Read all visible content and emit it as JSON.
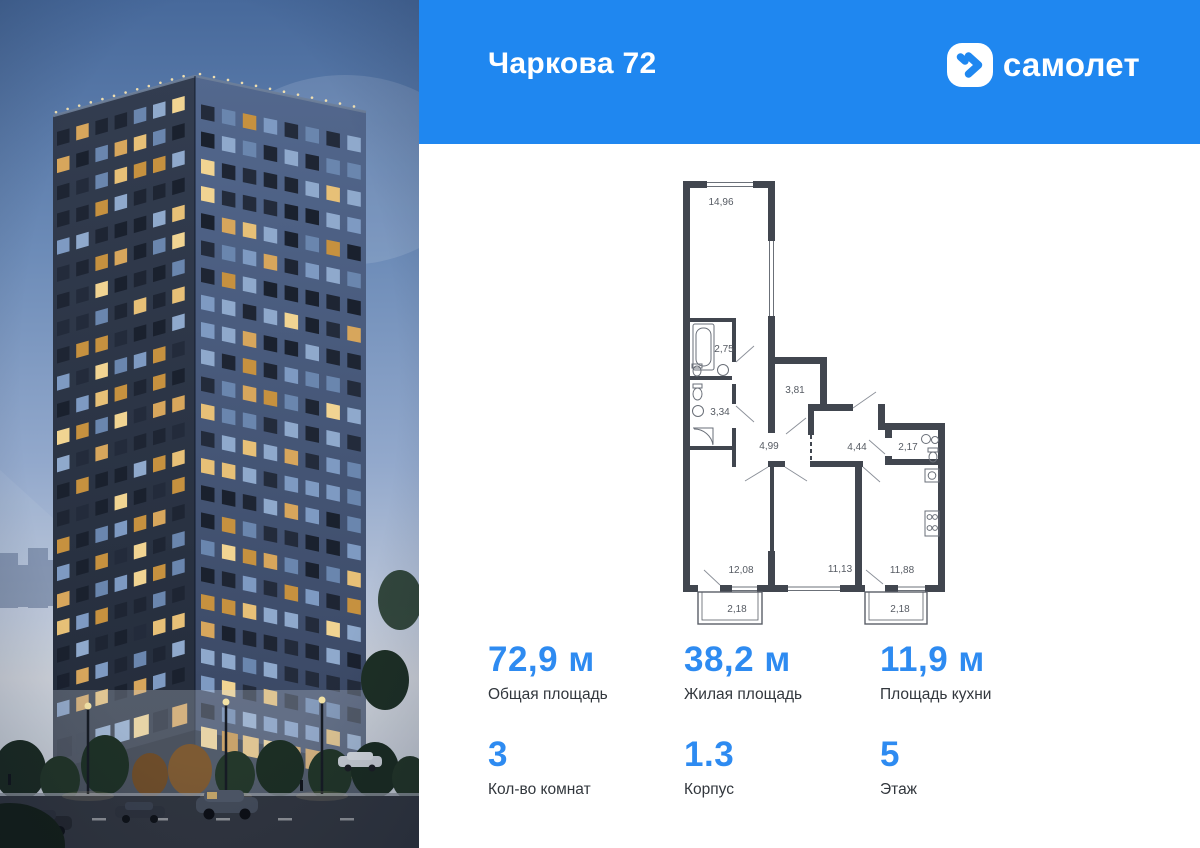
{
  "header": {
    "title": "Чаркова 72",
    "brand": "самолет",
    "logo_icon": "samolet-plane-icon"
  },
  "floor_plan": {
    "rooms": [
      {
        "name": "room",
        "area": "14,96"
      },
      {
        "name": "bathroom",
        "area": "2,75"
      },
      {
        "name": "bathroom",
        "area": "3,34"
      },
      {
        "name": "hallway",
        "area": "3,81"
      },
      {
        "name": "corridor",
        "area": "4,99"
      },
      {
        "name": "hallway",
        "area": "4,44"
      },
      {
        "name": "wc",
        "area": "2,17"
      },
      {
        "name": "room",
        "area": "12,08"
      },
      {
        "name": "room",
        "area": "11,13"
      },
      {
        "name": "kitchen",
        "area": "11,88"
      },
      {
        "name": "balcony",
        "area": "2,18"
      },
      {
        "name": "balcony",
        "area": "2,18"
      }
    ]
  },
  "stats": [
    {
      "value": "72,9 м",
      "label": "Общая площадь"
    },
    {
      "value": "38,2 м",
      "label": "Жилая площадь"
    },
    {
      "value": "11,9 м",
      "label": "Площадь кухни"
    },
    {
      "value": "3",
      "label": "Кол-во комнат"
    },
    {
      "value": "1.3",
      "label": "Корпус"
    },
    {
      "value": "5",
      "label": "Этаж"
    }
  ],
  "colors": {
    "header_blue": "#1f87f0",
    "stat_value_blue": "#2e8bf1",
    "plan_wall": "#41464f",
    "plan_label": "#565b63"
  }
}
